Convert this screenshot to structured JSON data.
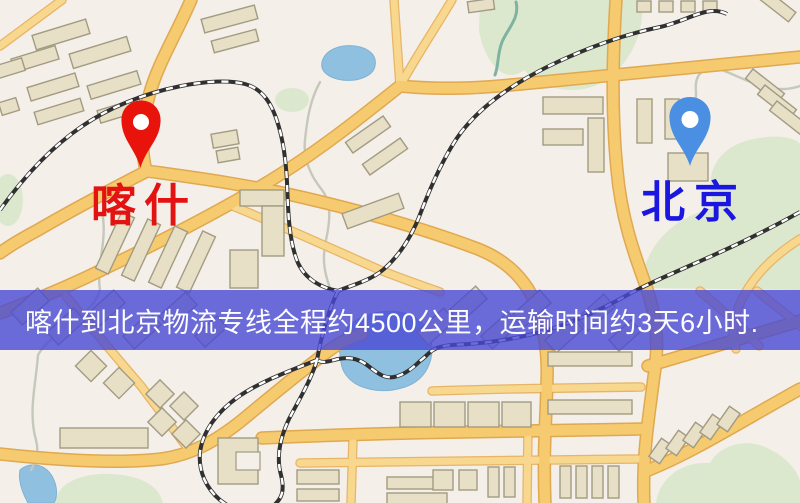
{
  "banner": {
    "text": "喀什到北京物流专线全程约4500公里，运输时间约3天6小时.",
    "background_color": "#4848d4",
    "text_color": "#fdfdfd"
  },
  "markers": {
    "origin": {
      "label": "喀什",
      "icon": "map-pin-icon",
      "pin_color": "#e8140c",
      "label_color": "#e21310"
    },
    "destination": {
      "label": "北京",
      "icon": "map-pin-icon",
      "pin_color": "#4a8fe2",
      "label_color": "#1b16e0"
    }
  },
  "map": {
    "type": "stylized-street-map",
    "palette": {
      "background": "#f4efe8",
      "road": "#f6cb70",
      "road_casing": "#e0a850",
      "road_minor": "#f8d88e",
      "building": "#e7e0c6",
      "building_outline": "#a29b83",
      "water": "#8fc0e0",
      "green_area": "#dce8cd",
      "railway": "#303030"
    }
  }
}
